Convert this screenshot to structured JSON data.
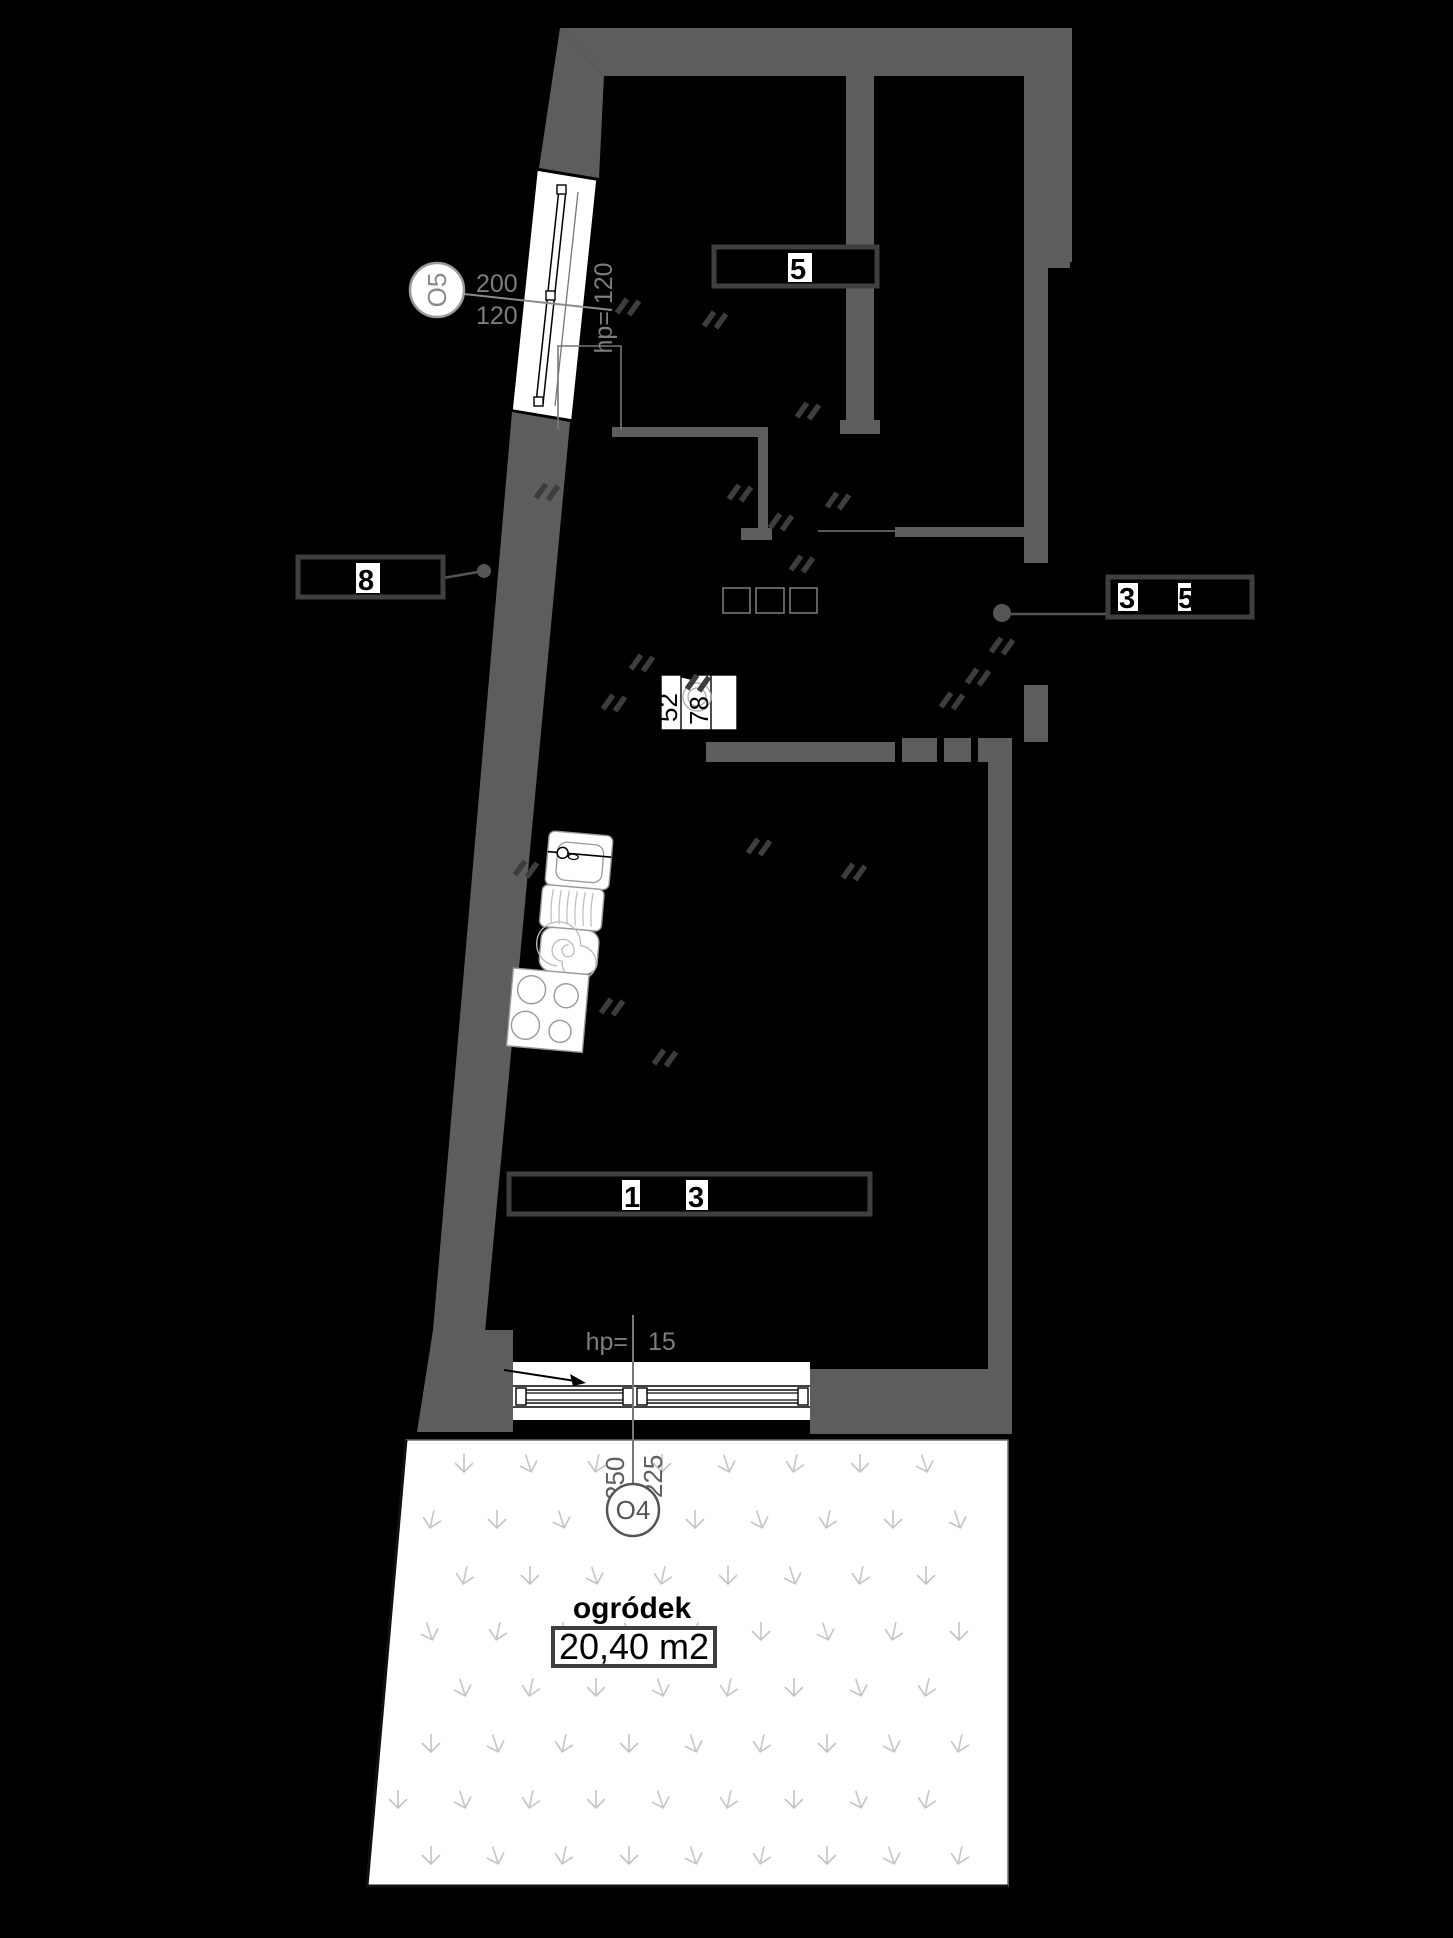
{
  "colors": {
    "paper": "#000000",
    "wall": "#5d5d5d",
    "dim_text": "#7d7d7d",
    "dim_line": "#8a8a8a",
    "label_border": "#3f3f3f",
    "grass": "#c4c4c4",
    "hatch": "#3d3d3d",
    "fixture": "#ffffff"
  },
  "windows": {
    "o5": {
      "id": "O5",
      "dim_top": "200",
      "dim_bottom": "120",
      "sill": "hp= 120"
    },
    "o4": {
      "id": "O4",
      "dim_left": "250",
      "dim_right": "225",
      "sill_prefix": "hp=",
      "sill_value": "15"
    }
  },
  "garden": {
    "name": "ogródek",
    "area": "20,40 m2"
  },
  "bath": {
    "dim_left": "52",
    "dim_mid": "78"
  },
  "labels": {
    "top_room": "5",
    "hall": "8",
    "entry_left": "3",
    "entry_right": "5",
    "living_left": "1",
    "living_right": "3"
  }
}
